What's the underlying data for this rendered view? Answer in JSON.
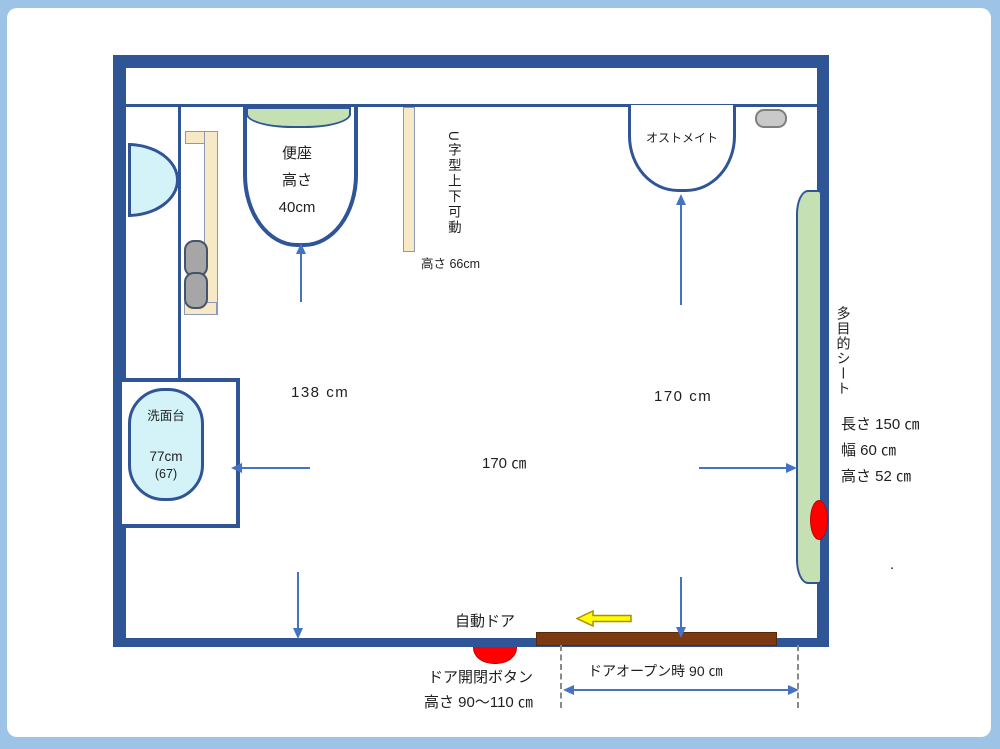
{
  "colors": {
    "frame": "#9DC3E6",
    "wall": "#2F5597",
    "arrow": "#4472C4",
    "fixture_green": "#C5E0B3",
    "fixture_cyan": "#D3F3F9",
    "fixture_cream": "#F7E9C6",
    "roll_grey": "#A6A6A6",
    "door_brown": "#7B3A10",
    "button_red": "#FF0000",
    "arrow_yellow": "#FFFF00",
    "text": "#1F1F1F"
  },
  "toilet": {
    "lines": [
      "便座",
      "高さ",
      "40cm"
    ]
  },
  "handrail": {
    "vertical_label": "U字型上下可動",
    "height_label": "高さ 66cm"
  },
  "ostomate": {
    "label": "オストメイト"
  },
  "multipurpose_sheet": {
    "vertical_label": "多目的シート",
    "specs": [
      "長さ 150 ㎝",
      "幅 60 ㎝",
      "高さ 52 ㎝"
    ]
  },
  "washbasin": {
    "label": "洗面台",
    "height": "77cm",
    "height_alt": "(67)"
  },
  "door": {
    "label": "自動ドア",
    "button_label": "ドア開閉ボタン",
    "button_height": "高さ 90～110 ㎝",
    "open_width_label": "ドアオープン時 90 ㎝"
  },
  "dimensions": {
    "left_depth": "138 cm",
    "right_depth": "170 cm",
    "center_width": "170 ㎝"
  },
  "stray_mark": "."
}
